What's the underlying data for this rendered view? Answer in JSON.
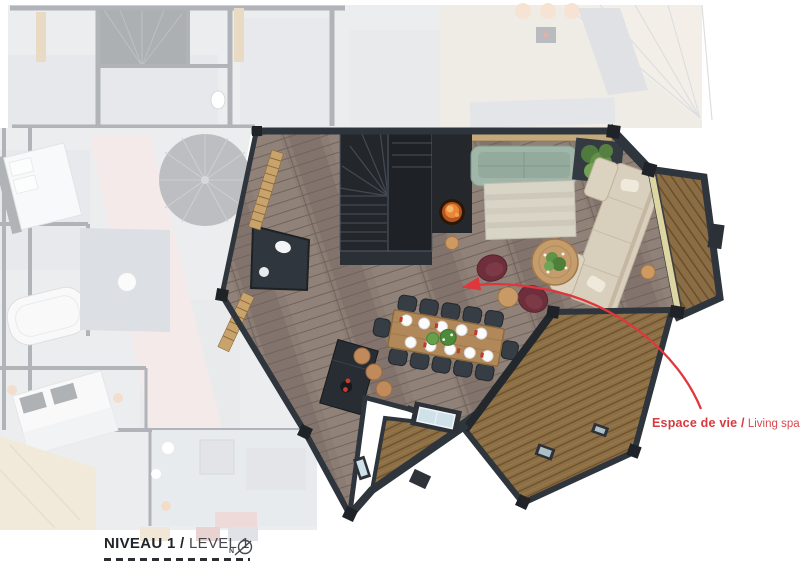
{
  "annotation_living": {
    "label_bold": "Espace de vie /",
    "label_light": " Living space",
    "color": "#d63a3f"
  },
  "title_block": {
    "level_bold": "NIVEAU 1 /",
    "level_light": " LEVEL 1",
    "north_letter": "N"
  },
  "plan_colors": {
    "accent_red_arrow": "#e0363c",
    "annotation_red": "#d63a3f",
    "wall_dark": "#2f353c",
    "living_floor_wood": "#8b7d74",
    "terrace_deck_wood": "#8d6f46",
    "balcony_deck_wood": "#8a6c45",
    "sofa_green": "#9fb6a8",
    "sofa_cream": "#d9cfbd",
    "armchair_burgundy": "#6e2e3b",
    "rug_beige": "#d8d4c6",
    "coffee_table_wood": "#c59c6c",
    "dining_table_wood": "#b1885a",
    "stool_wood": "#c08a5a",
    "fire_orange": "#e8873a",
    "faded_overlay_note": "adjacent areas shown washed-out"
  },
  "icons": {
    "north_icon": "compass-north-arrow",
    "pointer_icon": "curved-red-arrow"
  }
}
